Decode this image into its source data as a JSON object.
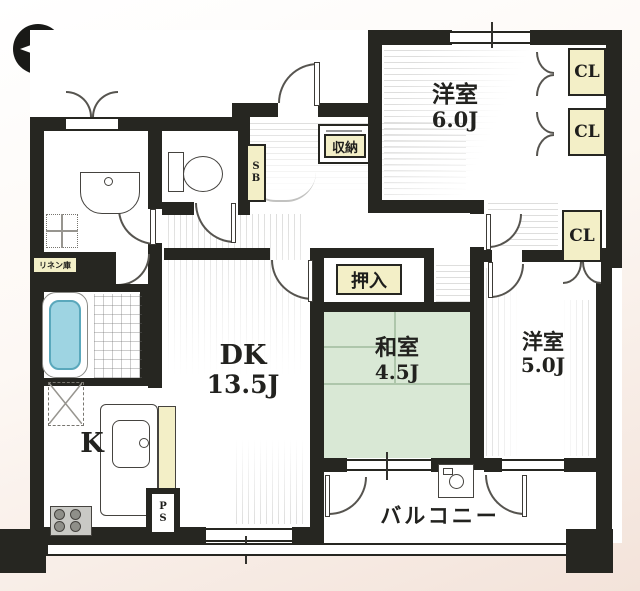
{
  "compass": {
    "north_label": "N"
  },
  "rooms": {
    "western_6": {
      "name": "洋室",
      "size": "6.0J"
    },
    "western_5": {
      "name": "洋室",
      "size": "5.0J"
    },
    "japanese": {
      "name": "和室",
      "size": "4.5J"
    },
    "dining_kitchen": {
      "name": "DK",
      "size": "13.5J"
    },
    "kitchen": {
      "name": "K"
    },
    "balcony": {
      "name": "バルコニー"
    }
  },
  "storage": {
    "closet": "CL",
    "oshiire": "押入",
    "shunou": "収納",
    "shoe_box": "SB",
    "pipe_space": "PS",
    "linen": "リネン庫"
  },
  "colors": {
    "wall": "#262621",
    "tatami_green": "#d9e8d5",
    "label_yellow": "#f3efc7",
    "bath_blue": "#79c4d8",
    "background_beige": "#f1ded4"
  }
}
